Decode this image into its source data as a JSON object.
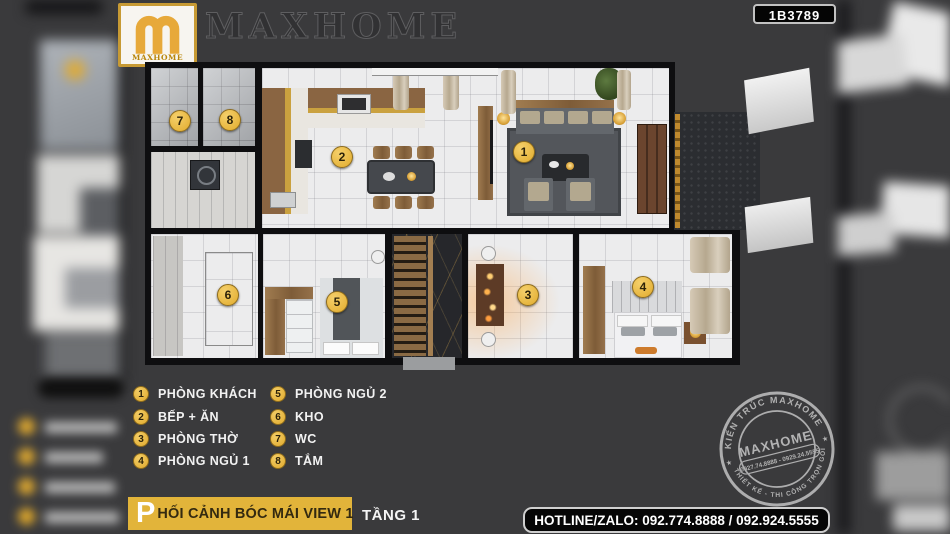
{
  "colors": {
    "background": "#3A3A3C",
    "gold": "#E8B644",
    "banner_yellow": "#E2B43A",
    "wall_black": "#0E0E10"
  },
  "header": {
    "logo_text": "MAXHOME",
    "brand_title": "MAXHOME",
    "plan_code": "1B3789"
  },
  "legend": {
    "items": [
      {
        "number": "1",
        "label": "PHÒNG KHÁCH"
      },
      {
        "number": "2",
        "label": "BẾP + ĂN"
      },
      {
        "number": "3",
        "label": "PHÒNG THỜ"
      },
      {
        "number": "4",
        "label": "PHÒNG NGỦ 1"
      },
      {
        "number": "5",
        "label": "PHÒNG NGỦ 2"
      },
      {
        "number": "6",
        "label": "KHO"
      },
      {
        "number": "7",
        "label": "WC"
      },
      {
        "number": "8",
        "label": "TẮM"
      }
    ]
  },
  "footer": {
    "view_title_initial": "P",
    "view_title_rest": "HỐI CẢNH BÓC MÁI VIEW 1",
    "floor_label": "TẦNG 1",
    "hotline": "HOTLINE/ZALO: 092.774.8888 / 092.924.5555"
  },
  "stamp": {
    "arc_top": "KIẾN TRÚC MAXHOME",
    "arc_bottom": "THIẾT KẾ - THI CÔNG TRỌN GÓI",
    "center_name": "MAXHOME",
    "center_phone": "0927.74.8888 - 0929.24.5555"
  }
}
